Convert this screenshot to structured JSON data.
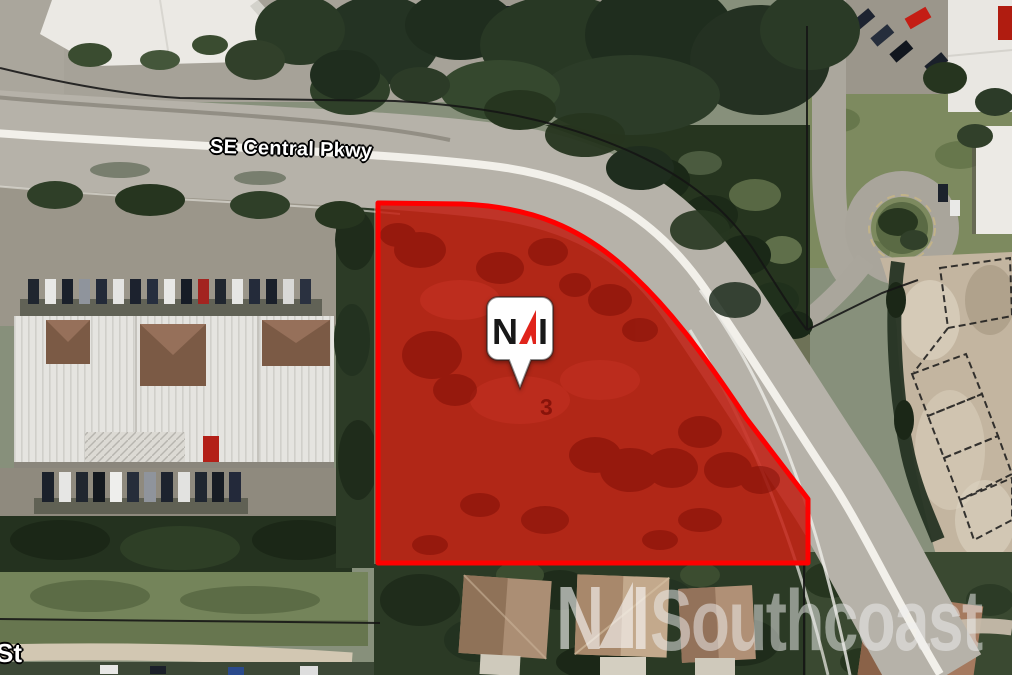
{
  "page": {
    "type": "aerial-property-map"
  },
  "map": {
    "street_label": "SE Central Pkwy",
    "cross_street_label": "St",
    "parcel": {
      "site_number": "3",
      "fill_color": "#c21408",
      "border_color": "#fe0000"
    },
    "pin": {
      "letter_n": "N",
      "letter_i": "I",
      "brand": "NAI",
      "triangle_color": "#e0241b",
      "bubble_color": "#ffffff",
      "letter_color": "#181818"
    }
  },
  "watermark": {
    "letter_n": "N",
    "letter_i": "I",
    "brand": "NAI",
    "name": "Southcoast",
    "color": "#ffffff"
  }
}
